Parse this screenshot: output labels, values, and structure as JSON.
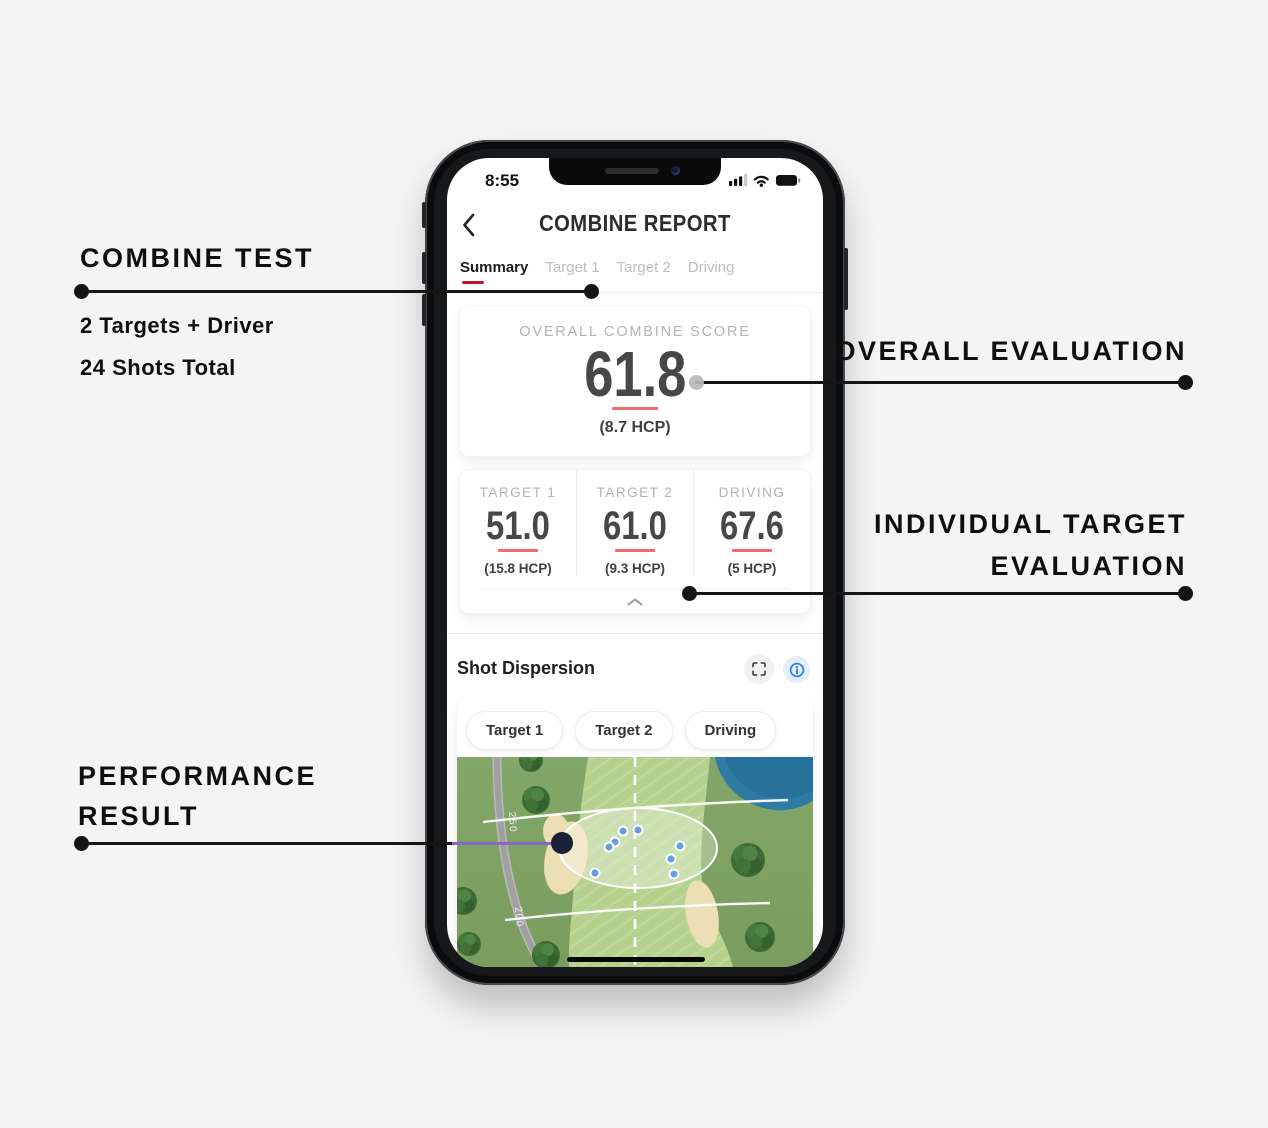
{
  "annotations": {
    "combine_test_title": "COMBINE TEST",
    "combine_test_sub1": "2 Targets + Driver",
    "combine_test_sub2": "24 Shots Total",
    "overall_evaluation": "OVERALL EVALUATION",
    "individual_evaluation_l1": "INDIVIDUAL TARGET",
    "individual_evaluation_l2": "EVALUATION",
    "performance_l1": "PERFORMANCE",
    "performance_l2": "RESULT"
  },
  "phone": {
    "status": {
      "time": "8:55"
    },
    "header": {
      "title": "COMBINE REPORT"
    },
    "tabs": [
      {
        "label": "Summary",
        "active": true
      },
      {
        "label": "Target 1",
        "active": false
      },
      {
        "label": "Target 2",
        "active": false
      },
      {
        "label": "Driving",
        "active": false
      }
    ],
    "overall_card": {
      "label": "OVERALL COMBINE SCORE",
      "score": "61.8",
      "hcp": "(8.7 HCP)"
    },
    "target_columns": [
      {
        "label": "TARGET 1",
        "score": "51.0",
        "hcp": "(15.8 HCP)"
      },
      {
        "label": "TARGET 2",
        "score": "61.0",
        "hcp": "(9.3 HCP)"
      },
      {
        "label": "DRIVING",
        "score": "67.6",
        "hcp": "(5 HCP)"
      }
    ],
    "dispersion": {
      "title": "Shot Dispersion",
      "filters": [
        "Target 1",
        "Target 2",
        "Driving"
      ],
      "map": {
        "distance_labels": [
          {
            "text": "250",
            "x": 52,
            "y": 55,
            "rot": 87
          },
          {
            "text": "200",
            "x": 58,
            "y": 150,
            "rot": 84
          }
        ],
        "shots": [
          [
            166,
            74
          ],
          [
            181,
            73
          ],
          [
            158,
            85
          ],
          [
            152,
            90
          ],
          [
            223,
            89
          ],
          [
            214,
            102
          ],
          [
            138,
            116
          ],
          [
            217,
            117
          ]
        ],
        "trees": [
          {
            "x": 74,
            "y": 3,
            "r": 12
          },
          {
            "x": 79,
            "y": 43,
            "r": 14
          },
          {
            "x": 6,
            "y": 144,
            "r": 14
          },
          {
            "x": 12,
            "y": 187,
            "r": 12
          },
          {
            "x": 89,
            "y": 198,
            "r": 14
          },
          {
            "x": 291,
            "y": 103,
            "r": 17
          },
          {
            "x": 303,
            "y": 180,
            "r": 15
          }
        ]
      }
    }
  },
  "icons": {
    "back": "chevron-left-icon",
    "expand": "fullscreen-icon",
    "info": "info-icon",
    "collapse": "chevron-up-icon",
    "status": [
      "cellular-signal-icon",
      "wifi-icon",
      "battery-icon"
    ]
  },
  "colors": {
    "accent_red": "#c8102e",
    "score_underline_red": "#ef6b6b",
    "info_blue": "#2f80ed",
    "shot_blue": "#64a0dc",
    "connector_purple": "#8a65c8",
    "fairway_green": "#b5d18e",
    "rough_green": "#7fa263",
    "water_blue": "#2f7ba3",
    "bunker_sand": "#ecdfb5"
  }
}
